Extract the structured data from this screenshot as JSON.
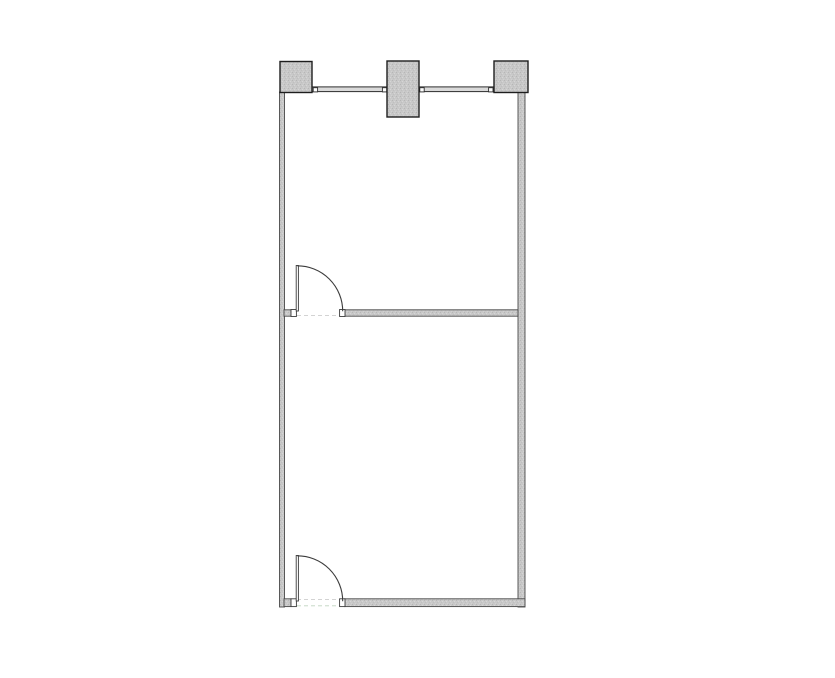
{
  "canvas": {
    "w": 835,
    "h": 678,
    "background": "#ffffff"
  },
  "palette": {
    "column_fill": "#c6c6c6",
    "column_stroke": "#1e1e1e",
    "wall_fill": "#c8c8c8",
    "wall_stroke": "#4a4a4a",
    "window_fill": "#dadada",
    "window_stroke": "#2e2e2e",
    "door_stroke": "#3c3c3c",
    "jamb_fill": "#fefefe",
    "threshold_gray": "#cdcdcd",
    "threshold_green": "#bfd4bf"
  },
  "columns": [
    {
      "name": "column-top-left",
      "x": 280,
      "y": 61.5,
      "w": 32,
      "h": 31
    },
    {
      "name": "column-top-middle",
      "x": 387,
      "y": 61,
      "w": 32,
      "h": 56
    },
    {
      "name": "column-top-right",
      "x": 494,
      "y": 61,
      "w": 34,
      "h": 31.5
    }
  ],
  "walls": [
    {
      "name": "left-exterior-wall",
      "x": 279.5,
      "y": 92,
      "w": 5,
      "h": 515
    },
    {
      "name": "right-exterior-wall",
      "x": 518,
      "y": 92,
      "w": 7,
      "h": 515
    },
    {
      "name": "partition-wall-left-stub",
      "x": 284,
      "y": 309.8,
      "w": 7,
      "h": 6.4
    },
    {
      "name": "partition-wall-main",
      "x": 344.6,
      "y": 309.8,
      "w": 173.4,
      "h": 6.4
    },
    {
      "name": "bottom-wall-left-stub",
      "x": 284,
      "y": 598.8,
      "w": 7,
      "h": 7.8
    },
    {
      "name": "bottom-wall-main",
      "x": 344.6,
      "y": 598.8,
      "w": 180.4,
      "h": 7.8
    }
  ],
  "windows": [
    {
      "name": "window-band-left",
      "x": 312,
      "y": 86.9,
      "w": 75,
      "h": 4.7
    },
    {
      "name": "window-band-right",
      "x": 419,
      "y": 86.9,
      "w": 75,
      "h": 4.7
    }
  ],
  "window_end_marks": [
    {
      "name": "window-end-mark",
      "x": 313.2,
      "y": 87.7,
      "w": 4.4,
      "h": 4.2
    },
    {
      "name": "window-end-mark",
      "x": 382.4,
      "y": 87.7,
      "w": 4.4,
      "h": 4.2
    },
    {
      "name": "window-end-mark",
      "x": 419.8,
      "y": 87.7,
      "w": 4.4,
      "h": 4.2
    },
    {
      "name": "window-end-mark",
      "x": 488.6,
      "y": 87.7,
      "w": 4.4,
      "h": 4.2
    }
  ],
  "doors": [
    {
      "name": "door-partition",
      "jambs": [
        {
          "x": 291,
          "y": 309.5,
          "w": 5.4,
          "h": 7.0
        },
        {
          "x": 339.6,
          "y": 309.5,
          "w": 5.4,
          "h": 7.0
        }
      ],
      "leaf": {
        "x": 296.2,
        "y": 265.5,
        "w": 2.2,
        "h": 45.5
      },
      "arc": "M 297.3 265.8 A 45.4 45.4 0 0 1 342.7 311.2"
    },
    {
      "name": "door-bottom",
      "jambs": [
        {
          "x": 291,
          "y": 598.8,
          "w": 5.4,
          "h": 7.8
        },
        {
          "x": 339.6,
          "y": 598.8,
          "w": 5.4,
          "h": 7.8
        }
      ],
      "leaf": {
        "x": 296.2,
        "y": 555.5,
        "w": 2.2,
        "h": 45.5
      },
      "arc": "M 297.3 555.8 A 45.4 45.4 0 0 1 342.7 601.2"
    }
  ],
  "thresholds": [
    {
      "name": "threshold-partition-door",
      "x1": 297,
      "y1": 315.6,
      "x2": 340,
      "y2": 315.6,
      "color": "threshold_gray"
    },
    {
      "name": "threshold-bottom-door-top",
      "x1": 297,
      "y1": 599.6,
      "x2": 340,
      "y2": 599.6,
      "color": "threshold_gray"
    },
    {
      "name": "threshold-bottom-door-green",
      "x1": 297,
      "y1": 605.8,
      "x2": 342.5,
      "y2": 605.8,
      "color": "threshold_green"
    }
  ]
}
